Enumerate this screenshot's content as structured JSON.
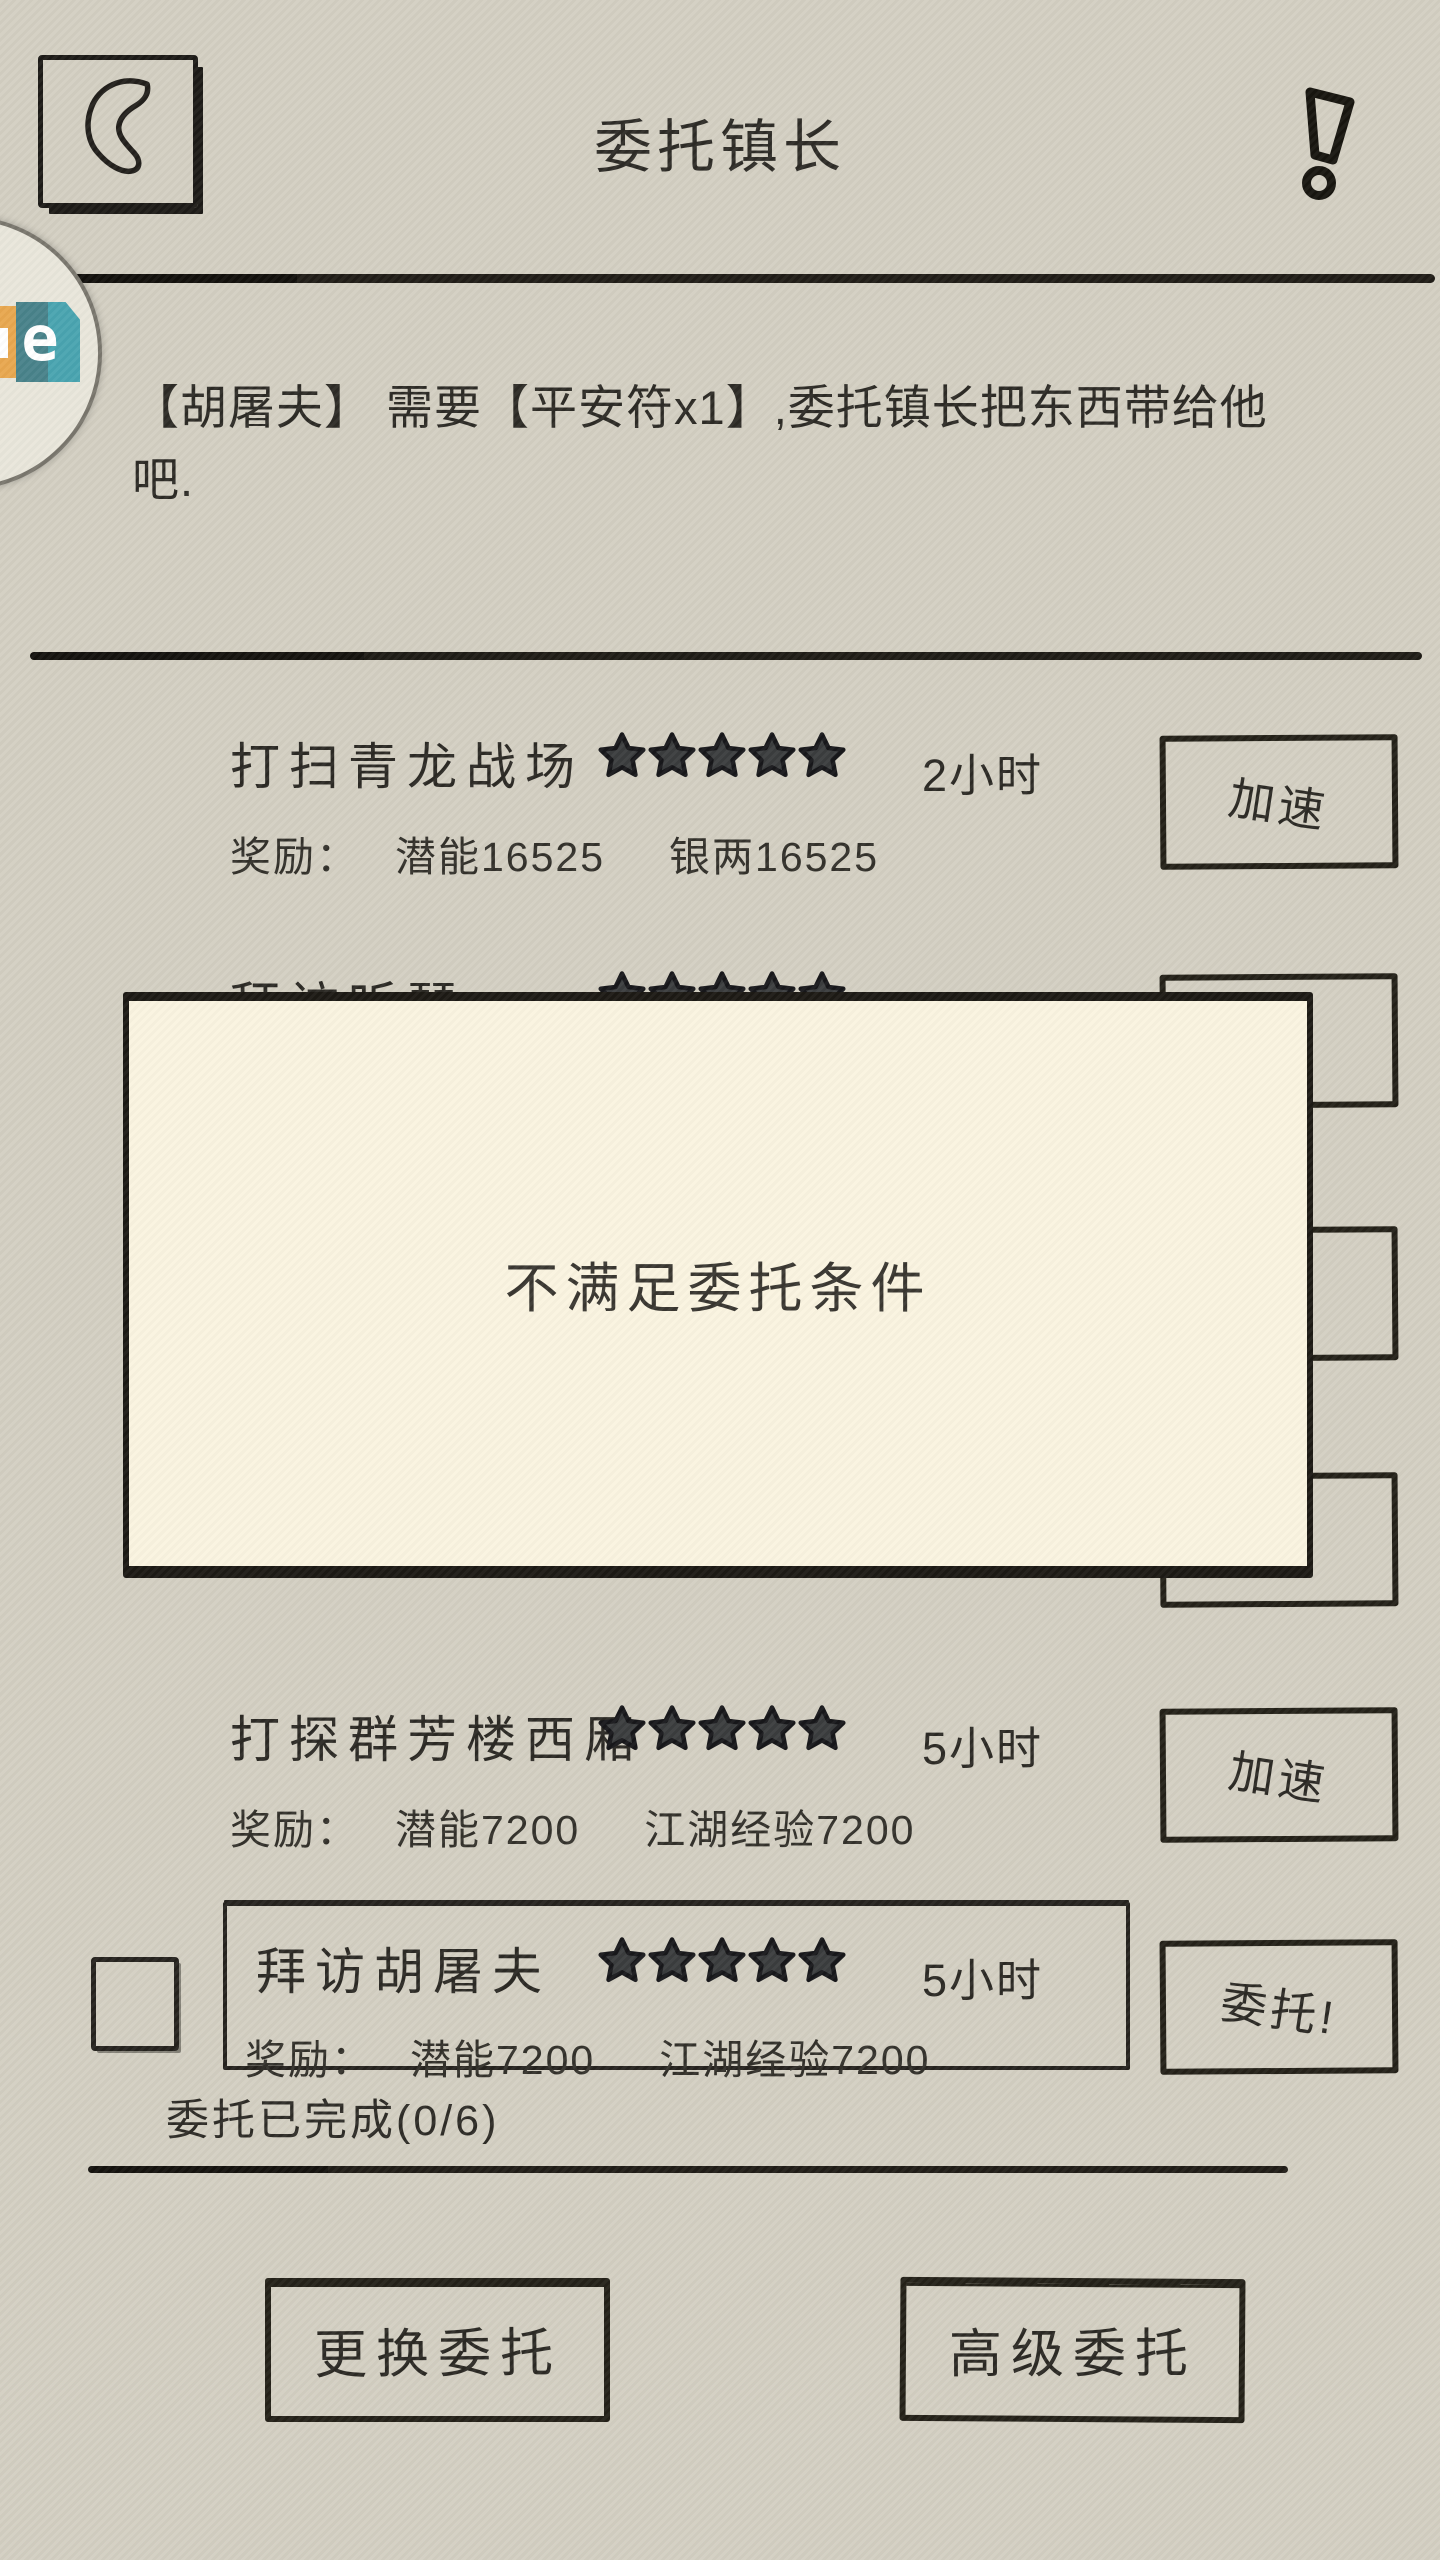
{
  "topbar": {
    "title": "委托镇长",
    "back_icon": "back-arrow-icon",
    "alert_icon": "exclamation-icon"
  },
  "floating_widget": {
    "letter": "e"
  },
  "description": {
    "line1": "【胡屠夫】  需要【平安符x1】,委托镇长把东西带给他",
    "line2": "吧."
  },
  "reward_label": "奖励：",
  "tasks": [
    {
      "title": "打扫青龙战场",
      "stars": 5,
      "duration": "2小时",
      "rewards": [
        "潜能16525",
        "银两16525"
      ],
      "button_label": "加速",
      "boxed": false,
      "checkbox": false,
      "hidden": false
    },
    {
      "title": "拜访听琴",
      "stars": 5,
      "duration": "5小时",
      "rewards": [],
      "button_label": "",
      "boxed": false,
      "checkbox": false,
      "hidden": true
    },
    {
      "title": "",
      "stars": 0,
      "duration": "",
      "rewards": [],
      "button_label": "",
      "boxed": false,
      "checkbox": false,
      "hidden": true
    },
    {
      "title": "",
      "stars": 0,
      "duration": "",
      "rewards": [],
      "button_label": "",
      "boxed": false,
      "checkbox": false,
      "hidden": true
    },
    {
      "title": "打探群芳楼西厢",
      "stars": 5,
      "duration": "5小时",
      "rewards": [
        "潜能7200",
        "江湖经验7200"
      ],
      "button_label": "加速",
      "boxed": false,
      "checkbox": false,
      "hidden": false
    },
    {
      "title": "拜访胡屠夫",
      "stars": 5,
      "duration": "5小时",
      "rewards": [
        "潜能7200",
        "江湖经验7200"
      ],
      "button_label": "委托!",
      "boxed": true,
      "checkbox": true,
      "checkbox_checked": false,
      "hidden": false
    }
  ],
  "modal": {
    "message": "不满足委托条件"
  },
  "completed": {
    "text": "委托已完成(0/6)"
  },
  "footer": {
    "change_label": "更换委托",
    "advanced_label": "高级委托"
  },
  "colors": {
    "background": "#d3cfc2",
    "ink": "#2b2925",
    "modal_background": "#faf4e0",
    "star_fill": "#3b3d3e",
    "widget_orange": "#e8a74f",
    "widget_teal_dark": "#48828a",
    "widget_teal_light": "#49a4b0"
  }
}
